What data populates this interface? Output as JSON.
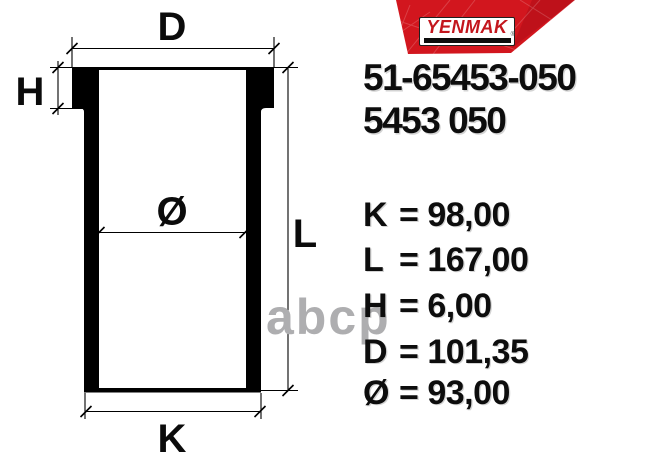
{
  "brand": {
    "logo_text": "YENMAK",
    "registered_mark": "®",
    "banner_color": "#d2161e",
    "logo_text_color": "#c3161d"
  },
  "part_numbers": {
    "primary": "51-65453-050",
    "secondary": "5453 050"
  },
  "equals": "=",
  "specs": [
    {
      "label": "K",
      "value": "98,00"
    },
    {
      "label": "L",
      "value": "167,00"
    },
    {
      "label": "H",
      "value": "6,00"
    },
    {
      "label": "D",
      "value": "101,35"
    },
    {
      "label": "Ø",
      "value": "93,00"
    }
  ],
  "diagram": {
    "labels": {
      "d": "D",
      "h": "H",
      "bore": "Ø",
      "l": "L",
      "k": "K"
    }
  },
  "watermark": "abcp"
}
